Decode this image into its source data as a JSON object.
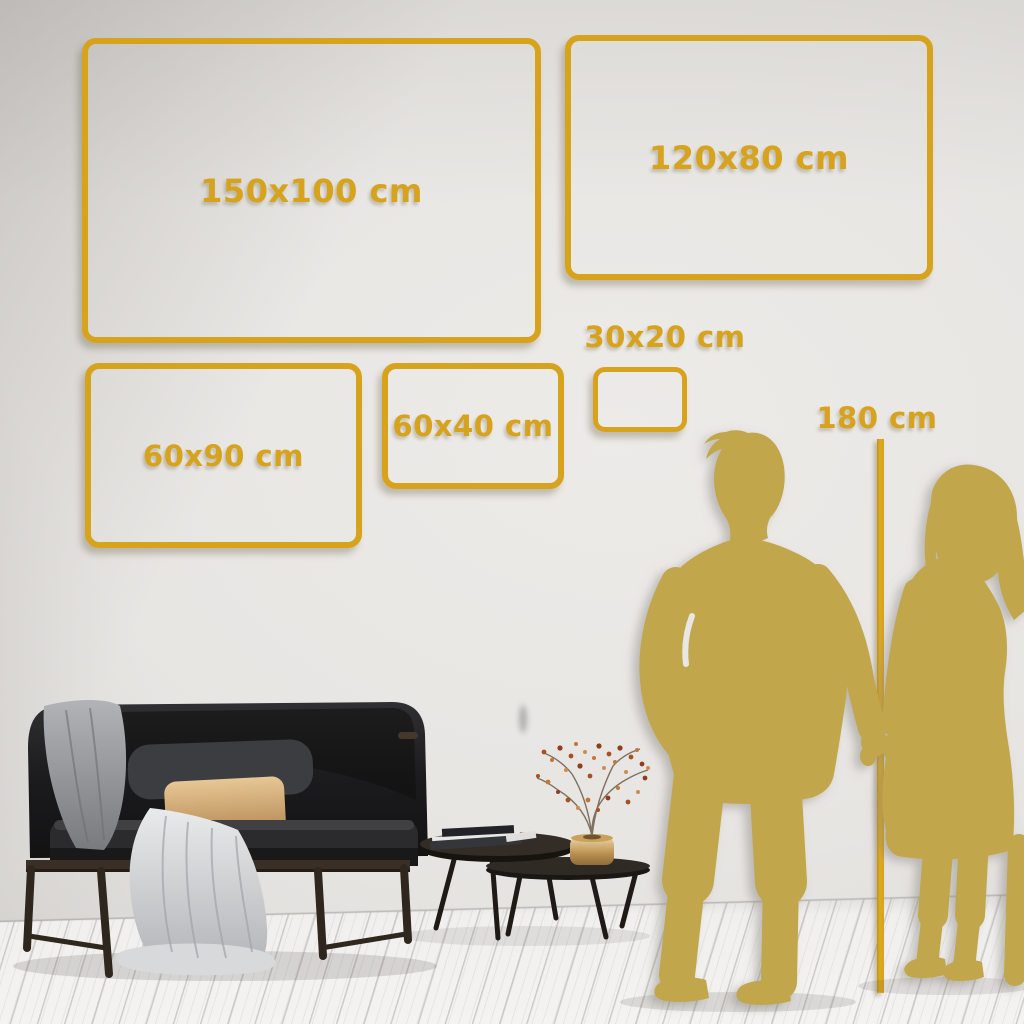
{
  "sizes": [
    "150x100 cm",
    "120x80 cm",
    "60x90 cm",
    "60x40 cm",
    "30x20 cm"
  ],
  "height_reference": "180 cm",
  "colors": {
    "accent_gold": "#d7a21c",
    "silhouette_gold": "#c1a64c",
    "wall": "#e7e5e2",
    "floor": "#f2f1ef",
    "sofa_dark": "#1c1c1e",
    "pillow_tan": "#d8b384",
    "berry_rust": "#b05a28",
    "brass": "#c9a express"
  },
  "illustrations": [
    "sofa-with-throw-blanket",
    "gray-blanket",
    "tan-pillow",
    "white-draped-throw",
    "nesting-coffee-tables",
    "book-stack",
    "brass-vase",
    "dried-branch-with-berries",
    "man-silhouette",
    "woman-silhouette",
    "height-reference-line"
  ]
}
